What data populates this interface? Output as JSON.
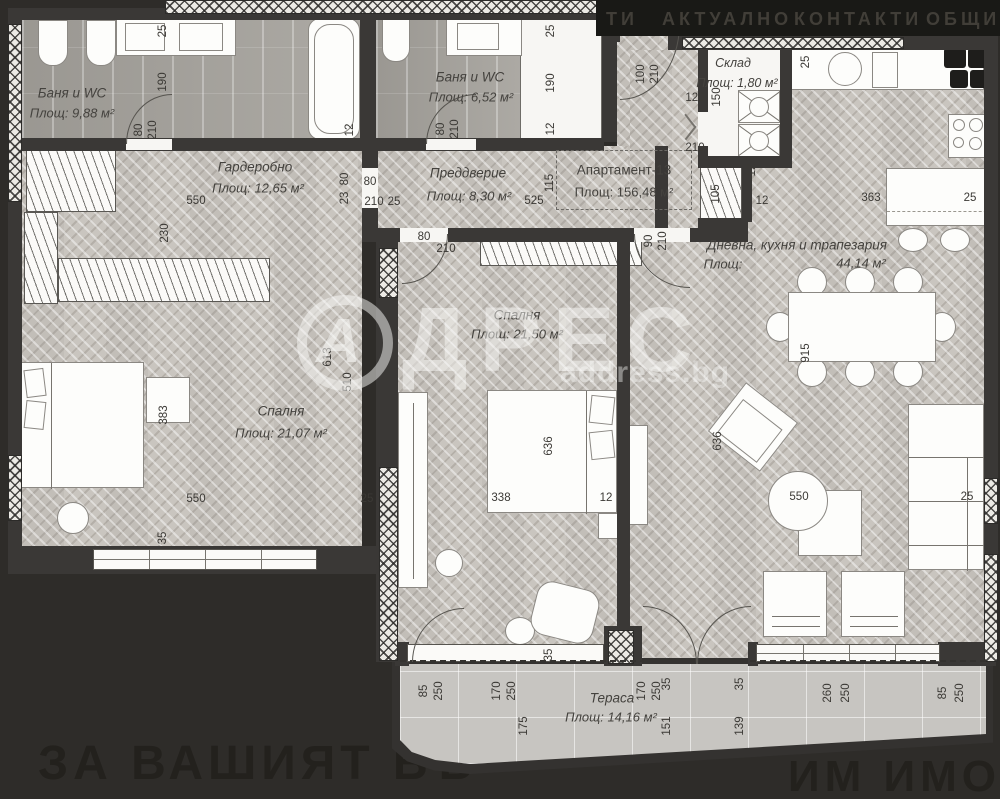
{
  "nav": {
    "items": [
      "ТИ",
      "АКТУАЛНО",
      "КОНТАКТИ",
      "ОБЩИ У"
    ]
  },
  "watermark": {
    "letter": "А",
    "brand": "ДРЕС",
    "domain": "address.bg"
  },
  "slogan": {
    "left": "ЗА ВАШИЯТ БЪ",
    "right": "ИМ ИМОТ!"
  },
  "apartment": {
    "name": "Апартамент-13",
    "area": "Площ: 156,48 м²"
  },
  "rooms": [
    {
      "id": "bath1",
      "name": "Баня и WC",
      "area": "Площ: 9,88 м²"
    },
    {
      "id": "bath2",
      "name": "Баня и WC",
      "area": "Площ: 6,52 м²"
    },
    {
      "id": "wardrobe",
      "name": "Гардеробно",
      "area": "Площ: 12,65 м²"
    },
    {
      "id": "hall",
      "name": "Преддверие",
      "area": "Площ: 8,30 м²"
    },
    {
      "id": "storage",
      "name": "Склад",
      "area": "Площ: 1,80 м²"
    },
    {
      "id": "living",
      "name": "Дневна, кухня и трапезария",
      "area_label": "Площ:",
      "area_value": "44,14 м²"
    },
    {
      "id": "bedroom1",
      "name": "Спалня",
      "area": "Площ: 21,07 м²"
    },
    {
      "id": "bedroom2",
      "name": "Спалня",
      "area": "Площ: 21,50 м²"
    },
    {
      "id": "terrace",
      "name": "Тераса",
      "area": "Площ: 14,16 м²"
    }
  ],
  "colors": {
    "background": "#2e2c29",
    "wall": "#3a3836",
    "floor": "#c9c5bf",
    "bath_floor": "#a6a39d",
    "terrace_floor": "#c7c5c1",
    "label_text": "#44423e"
  },
  "dimensions": [
    {
      "t": "25",
      "x": 163,
      "y": 31,
      "v": 1
    },
    {
      "t": "190",
      "x": 163,
      "y": 82,
      "v": 1
    },
    {
      "t": "80",
      "x": 139,
      "y": 130,
      "v": 1
    },
    {
      "t": "210",
      "x": 153,
      "y": 130,
      "v": 1
    },
    {
      "t": "12",
      "x": 350,
      "y": 130,
      "v": 1
    },
    {
      "t": "80",
      "x": 441,
      "y": 129,
      "v": 1
    },
    {
      "t": "210",
      "x": 455,
      "y": 129,
      "v": 1
    },
    {
      "t": "25",
      "x": 551,
      "y": 31,
      "v": 1
    },
    {
      "t": "190",
      "x": 551,
      "y": 83,
      "v": 1
    },
    {
      "t": "12",
      "x": 551,
      "y": 129,
      "v": 1
    },
    {
      "t": "230",
      "x": 165,
      "y": 233,
      "v": 1
    },
    {
      "t": "550",
      "x": 196,
      "y": 201,
      "v": 0
    },
    {
      "t": "80",
      "x": 345,
      "y": 179,
      "v": 1
    },
    {
      "t": "23",
      "x": 345,
      "y": 198,
      "v": 1
    },
    {
      "t": "80",
      "x": 370,
      "y": 182,
      "v": 0
    },
    {
      "t": "210",
      "x": 374,
      "y": 202,
      "v": 0
    },
    {
      "t": "25",
      "x": 394,
      "y": 202,
      "v": 0
    },
    {
      "t": "115",
      "x": 550,
      "y": 183,
      "v": 1
    },
    {
      "t": "525",
      "x": 534,
      "y": 201,
      "v": 0
    },
    {
      "t": "100",
      "x": 641,
      "y": 74,
      "v": 1
    },
    {
      "t": "210",
      "x": 655,
      "y": 74,
      "v": 1
    },
    {
      "t": "120",
      "x": 695,
      "y": 98,
      "v": 0
    },
    {
      "t": "150",
      "x": 717,
      "y": 97,
      "v": 1
    },
    {
      "t": "210",
      "x": 695,
      "y": 148,
      "v": 0
    },
    {
      "t": "12",
      "x": 752,
      "y": 170,
      "v": 1
    },
    {
      "t": "105",
      "x": 716,
      "y": 194,
      "v": 1
    },
    {
      "t": "12",
      "x": 762,
      "y": 201,
      "v": 0
    },
    {
      "t": "25",
      "x": 806,
      "y": 62,
      "v": 1
    },
    {
      "t": "363",
      "x": 871,
      "y": 198,
      "v": 0
    },
    {
      "t": "25",
      "x": 970,
      "y": 198,
      "v": 0
    },
    {
      "t": "90",
      "x": 649,
      "y": 241,
      "v": 1
    },
    {
      "t": "210",
      "x": 663,
      "y": 241,
      "v": 1
    },
    {
      "t": "80",
      "x": 424,
      "y": 237,
      "v": 0
    },
    {
      "t": "210",
      "x": 446,
      "y": 249,
      "v": 0
    },
    {
      "t": "613",
      "x": 328,
      "y": 357,
      "v": 1
    },
    {
      "t": "510",
      "x": 348,
      "y": 382,
      "v": 1
    },
    {
      "t": "383",
      "x": 164,
      "y": 415,
      "v": 1
    },
    {
      "t": "35",
      "x": 163,
      "y": 538,
      "v": 1
    },
    {
      "t": "550",
      "x": 196,
      "y": 499,
      "v": 0
    },
    {
      "t": "25",
      "x": 367,
      "y": 499,
      "v": 0
    },
    {
      "t": "636",
      "x": 549,
      "y": 446,
      "v": 1
    },
    {
      "t": "338",
      "x": 501,
      "y": 498,
      "v": 0
    },
    {
      "t": "12",
      "x": 606,
      "y": 498,
      "v": 0
    },
    {
      "t": "35",
      "x": 549,
      "y": 655,
      "v": 1
    },
    {
      "t": "915",
      "x": 806,
      "y": 353,
      "v": 1
    },
    {
      "t": "636",
      "x": 718,
      "y": 441,
      "v": 1
    },
    {
      "t": "550",
      "x": 799,
      "y": 497,
      "v": 0
    },
    {
      "t": "25",
      "x": 967,
      "y": 497,
      "v": 0
    },
    {
      "t": "85",
      "x": 424,
      "y": 691,
      "v": 1
    },
    {
      "t": "250",
      "x": 439,
      "y": 691,
      "v": 1
    },
    {
      "t": "170",
      "x": 497,
      "y": 691,
      "v": 1
    },
    {
      "t": "250",
      "x": 512,
      "y": 691,
      "v": 1
    },
    {
      "t": "175",
      "x": 524,
      "y": 726,
      "v": 1
    },
    {
      "t": "170",
      "x": 642,
      "y": 691,
      "v": 1
    },
    {
      "t": "250",
      "x": 657,
      "y": 691,
      "v": 1
    },
    {
      "t": "35",
      "x": 667,
      "y": 684,
      "v": 1
    },
    {
      "t": "151",
      "x": 667,
      "y": 726,
      "v": 1
    },
    {
      "t": "35",
      "x": 740,
      "y": 684,
      "v": 1
    },
    {
      "t": "139",
      "x": 740,
      "y": 726,
      "v": 1
    },
    {
      "t": "260",
      "x": 828,
      "y": 693,
      "v": 1
    },
    {
      "t": "250",
      "x": 846,
      "y": 693,
      "v": 1
    },
    {
      "t": "85",
      "x": 943,
      "y": 693,
      "v": 1
    },
    {
      "t": "250",
      "x": 960,
      "y": 693,
      "v": 1
    }
  ]
}
